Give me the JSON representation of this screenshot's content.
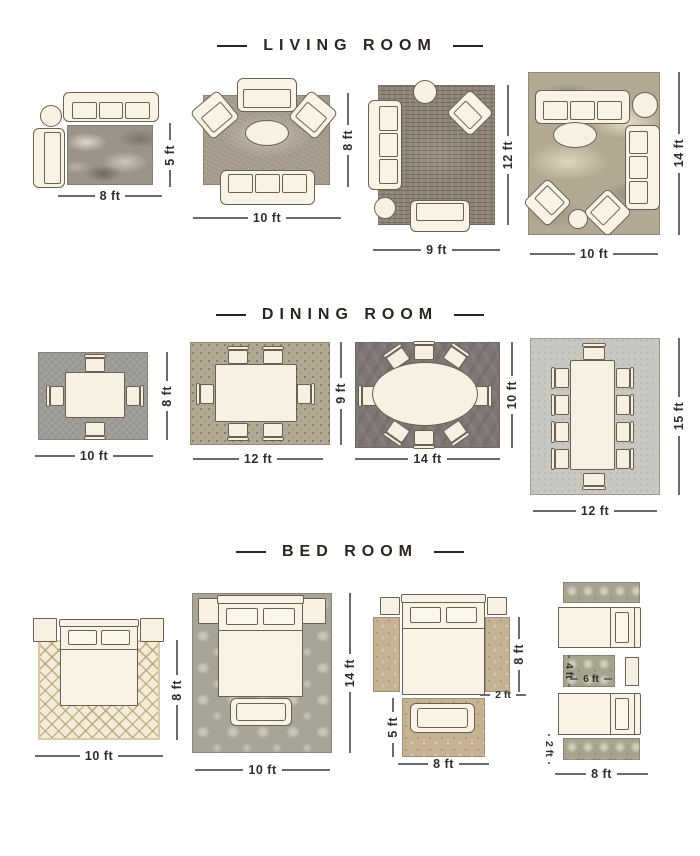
{
  "palette": {
    "background": "#ffffff",
    "heading_text": "#2d251d",
    "dimension_text": "#2f2f2f",
    "furniture_fill": "#f8f3e5",
    "furniture_outline": "#6b6153",
    "rug_colors": {
      "living_1_marble_gray": "#99938a",
      "living_2_texture_tan": "#a89e90",
      "living_3_striated_taupe": "#8d8377",
      "living_4_marble_beige": "#b4a995",
      "dining_1_gray": "#9d9c98",
      "dining_2_mosaic": "#b2a894",
      "dining_3_dark_gray": "#7d7674",
      "dining_4_light_gray": "#c8c7c1",
      "bed_1_cream_diamond": "#f3ecd9",
      "bed_2_sage_damask": "#a7a598",
      "bed_3_tan": "#c4b293",
      "bed_4_olive": "#a6a38e"
    }
  },
  "sections": [
    {
      "title": "LIVING ROOM",
      "layouts": [
        {
          "width_label": "8 ft",
          "height_label": "5 ft"
        },
        {
          "width_label": "10 ft",
          "height_label": "8 ft"
        },
        {
          "width_label": "9 ft",
          "height_label": "12 ft"
        },
        {
          "width_label": "10 ft",
          "height_label": "14 ft"
        }
      ]
    },
    {
      "title": "DINING ROOM",
      "layouts": [
        {
          "width_label": "10 ft",
          "height_label": "8 ft"
        },
        {
          "width_label": "12 ft",
          "height_label": "9 ft"
        },
        {
          "width_label": "14 ft",
          "height_label": "10 ft"
        },
        {
          "width_label": "12 ft",
          "height_label": "15 ft"
        }
      ]
    },
    {
      "title": "BED ROOM",
      "layouts": [
        {
          "width_label": "10 ft",
          "height_label": "8 ft"
        },
        {
          "width_label": "10 ft",
          "height_label": "14 ft"
        },
        {
          "width_label": "8 ft",
          "runner_length_label": "8 ft",
          "runner_width_label": "2 ft",
          "foot_rug_height_label": "5 ft"
        },
        {
          "width_label": "8 ft",
          "runner_width_label": "2 ft",
          "accent_rug_width_label": "6 ft",
          "accent_rug_height_label": "4 ft"
        }
      ]
    }
  ]
}
